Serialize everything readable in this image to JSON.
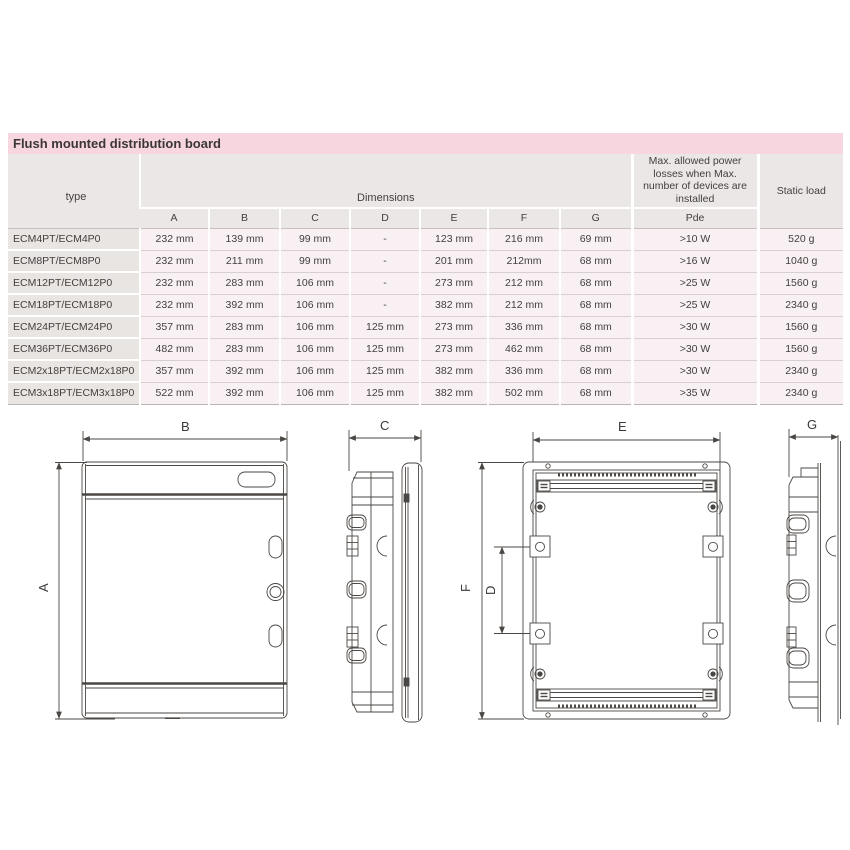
{
  "page": {
    "title": "Flush mounted distribution board"
  },
  "palette": {
    "title_band_pink": "#f8d6e0",
    "header_gray": "#eae7e6",
    "type_column_gray": "#e8e5e3",
    "data_cell_pink": "#f8f0f2",
    "drawing_line": "#4b4744",
    "text": "#3c3a39"
  },
  "table": {
    "type_header": "type",
    "dimensions_header": "Dimensions",
    "dim_letters": [
      "A",
      "B",
      "C",
      "D",
      "E",
      "F",
      "G"
    ],
    "pde_header": "Max. allowed power losses when Max. number of devices are installed",
    "pde_sub_header": "Pde",
    "static_header": "Static load",
    "rows": [
      {
        "type": "ECM4PT/ECM4P0",
        "a": "232 mm",
        "b": "139 mm",
        "c": "99 mm",
        "d": "-",
        "e": "123 mm",
        "f": "216 mm",
        "g": "69 mm",
        "pde": ">10 W",
        "load": "520 g"
      },
      {
        "type": "ECM8PT/ECM8P0",
        "a": "232 mm",
        "b": "211 mm",
        "c": "99 mm",
        "d": "-",
        "e": "201 mm",
        "f": "212mm",
        "g": "68 mm",
        "pde": ">16 W",
        "load": "1040 g"
      },
      {
        "type": "ECM12PT/ECM12P0",
        "a": "232 mm",
        "b": "283 mm",
        "c": "106 mm",
        "d": "-",
        "e": "273 mm",
        "f": "212 mm",
        "g": "68 mm",
        "pde": ">25 W",
        "load": "1560 g"
      },
      {
        "type": "ECM18PT/ECM18P0",
        "a": "232 mm",
        "b": "392 mm",
        "c": "106 mm",
        "d": "-",
        "e": "382 mm",
        "f": "212 mm",
        "g": "68 mm",
        "pde": ">25 W",
        "load": "2340 g"
      },
      {
        "type": "ECM24PT/ECM24P0",
        "a": "357 mm",
        "b": "283 mm",
        "c": "106 mm",
        "d": "125 mm",
        "e": "273 mm",
        "f": "336 mm",
        "g": "68 mm",
        "pde": ">30 W",
        "load": "1560 g"
      },
      {
        "type": "ECM36PT/ECM36P0",
        "a": "482 mm",
        "b": "283 mm",
        "c": "106 mm",
        "d": "125 mm",
        "e": "273 mm",
        "f": "462 mm",
        "g": "68 mm",
        "pde": ">30 W",
        "load": "1560 g"
      },
      {
        "type": "ECM2x18PT/ECM2x18P0",
        "a": "357 mm",
        "b": "392 mm",
        "c": "106 mm",
        "d": "125 mm",
        "e": "382 mm",
        "f": "336 mm",
        "g": "68 mm",
        "pde": ">30 W",
        "load": "2340 g"
      },
      {
        "type": "ECM3x18PT/ECM3x18P0",
        "a": "522 mm",
        "b": "392 mm",
        "c": "106 mm",
        "d": "125 mm",
        "e": "382 mm",
        "f": "502 mm",
        "g": "68 mm",
        "pde": ">35 W",
        "load": "2340 g"
      }
    ]
  },
  "drawings": {
    "front_view": {
      "width_label": "B",
      "height_label": "A"
    },
    "side_view": {
      "depth_label": "C"
    },
    "back_view": {
      "width_label": "E",
      "height_label": "F",
      "hole_spacing_label": "D"
    },
    "profile_view": {
      "depth_label": "G"
    }
  }
}
